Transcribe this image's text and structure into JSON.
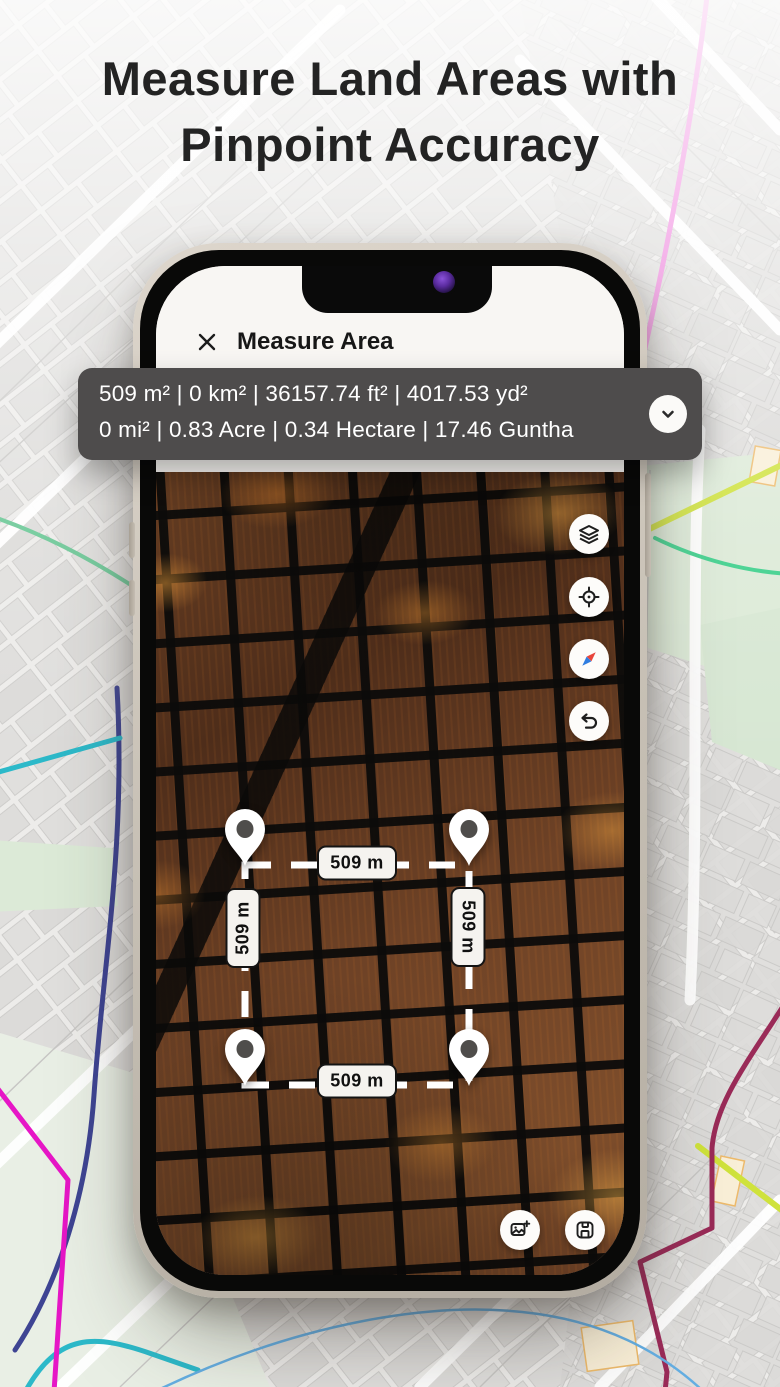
{
  "title": {
    "line1": "Measure Land Areas with",
    "line2": "Pinpoint Accuracy"
  },
  "phone": {
    "header": {
      "title": "Measure Area"
    },
    "measurement_bar": {
      "line1": "509 m² | 0 km² | 36157.74 ft² | 4017.53 yd²",
      "line2": "0 mi² | 0.83 Acre | 0.34 Hectare | 17.46 Guntha"
    },
    "map": {
      "side_labels": {
        "top": "509 m",
        "right": "509 m",
        "bottom": "509 m",
        "left": "509 m"
      },
      "controls": [
        "layers",
        "locate",
        "compass",
        "undo"
      ],
      "actions": [
        "screenshot-add",
        "save"
      ]
    }
  },
  "icons": {
    "close": "x-cross",
    "chevron_down": "chevron-down",
    "layers": "stacked-layers",
    "locate": "crosshair-target",
    "compass": "compass-needle",
    "undo": "curved-back-arrow",
    "screenshot_add": "image-plus",
    "save": "floppy-disk",
    "pin": "map-pin"
  },
  "colors": {
    "measurement_bar_bg": "#4e4c4c",
    "phone_frame": "#ccc5ba",
    "camera_dot": "#5b2ca0",
    "compass_red": "#e8453c",
    "compass_blue": "#2f7de1",
    "dash_line": "#ffffff",
    "background_map": "#edecea"
  }
}
